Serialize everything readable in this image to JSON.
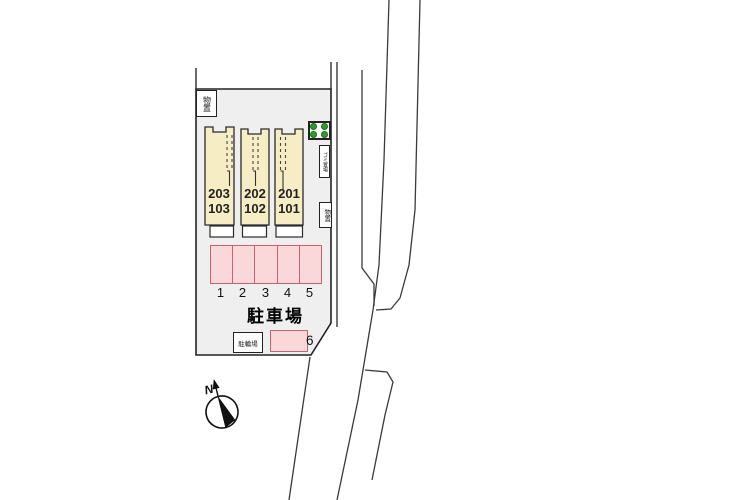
{
  "site_plan": {
    "buildings": [
      {
        "upper": "203",
        "lower": "103"
      },
      {
        "upper": "202",
        "lower": "102"
      },
      {
        "upper": "201",
        "lower": "101"
      }
    ],
    "labels": {
      "storage_top": "物置",
      "storage_right": "物置",
      "garbage": "ゴミ置場",
      "bicycle": "駐輪場",
      "parking_title": "駐車場"
    },
    "parking_spaces": [
      "1",
      "2",
      "3",
      "4",
      "5"
    ],
    "parking_space_6": "6",
    "compass": {
      "north": "N"
    },
    "colors": {
      "site_fill": "#efefef",
      "building_fill": "#f6edc4",
      "parking_fill": "#fad8da",
      "parking_border": "#c4636f",
      "planting_green": "#2d9b2d",
      "boundary_line": "#2a2a2a"
    }
  }
}
